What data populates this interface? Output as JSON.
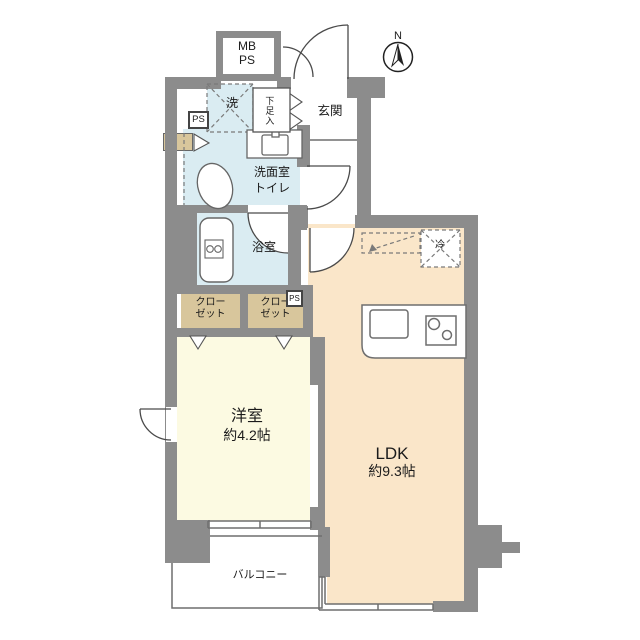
{
  "colors": {
    "wall": "#8c8c8c",
    "water": "#daecf2",
    "ldk": "#fae6c9",
    "bedroom": "#fcfae2",
    "closet": "#d8c69c"
  },
  "compass": {
    "north_label": "N"
  },
  "rooms": {
    "mbps": {
      "line1": "MB",
      "line2": "PS"
    },
    "entrance": {
      "label": "玄関"
    },
    "shoe_cabinet": {
      "label": "下足入"
    },
    "laundry": {
      "label": "洗"
    },
    "pipe_space_upper": {
      "label": "PS"
    },
    "washroom": {
      "line1": "洗面室",
      "line2": "トイレ"
    },
    "bathroom": {
      "label": "浴室"
    },
    "closet_left": {
      "line1": "クロー",
      "line2": "ゼット"
    },
    "closet_right": {
      "line1": "クロー",
      "line2": "ゼット"
    },
    "pipe_space_closet": {
      "label": "PS"
    },
    "refrigerator": {
      "label": "冷"
    },
    "bedroom": {
      "label": "洋室",
      "size": "約4.2帖"
    },
    "ldk": {
      "label": "LDK",
      "size": "約9.3帖"
    },
    "balcony": {
      "label": "バルコニー"
    }
  }
}
